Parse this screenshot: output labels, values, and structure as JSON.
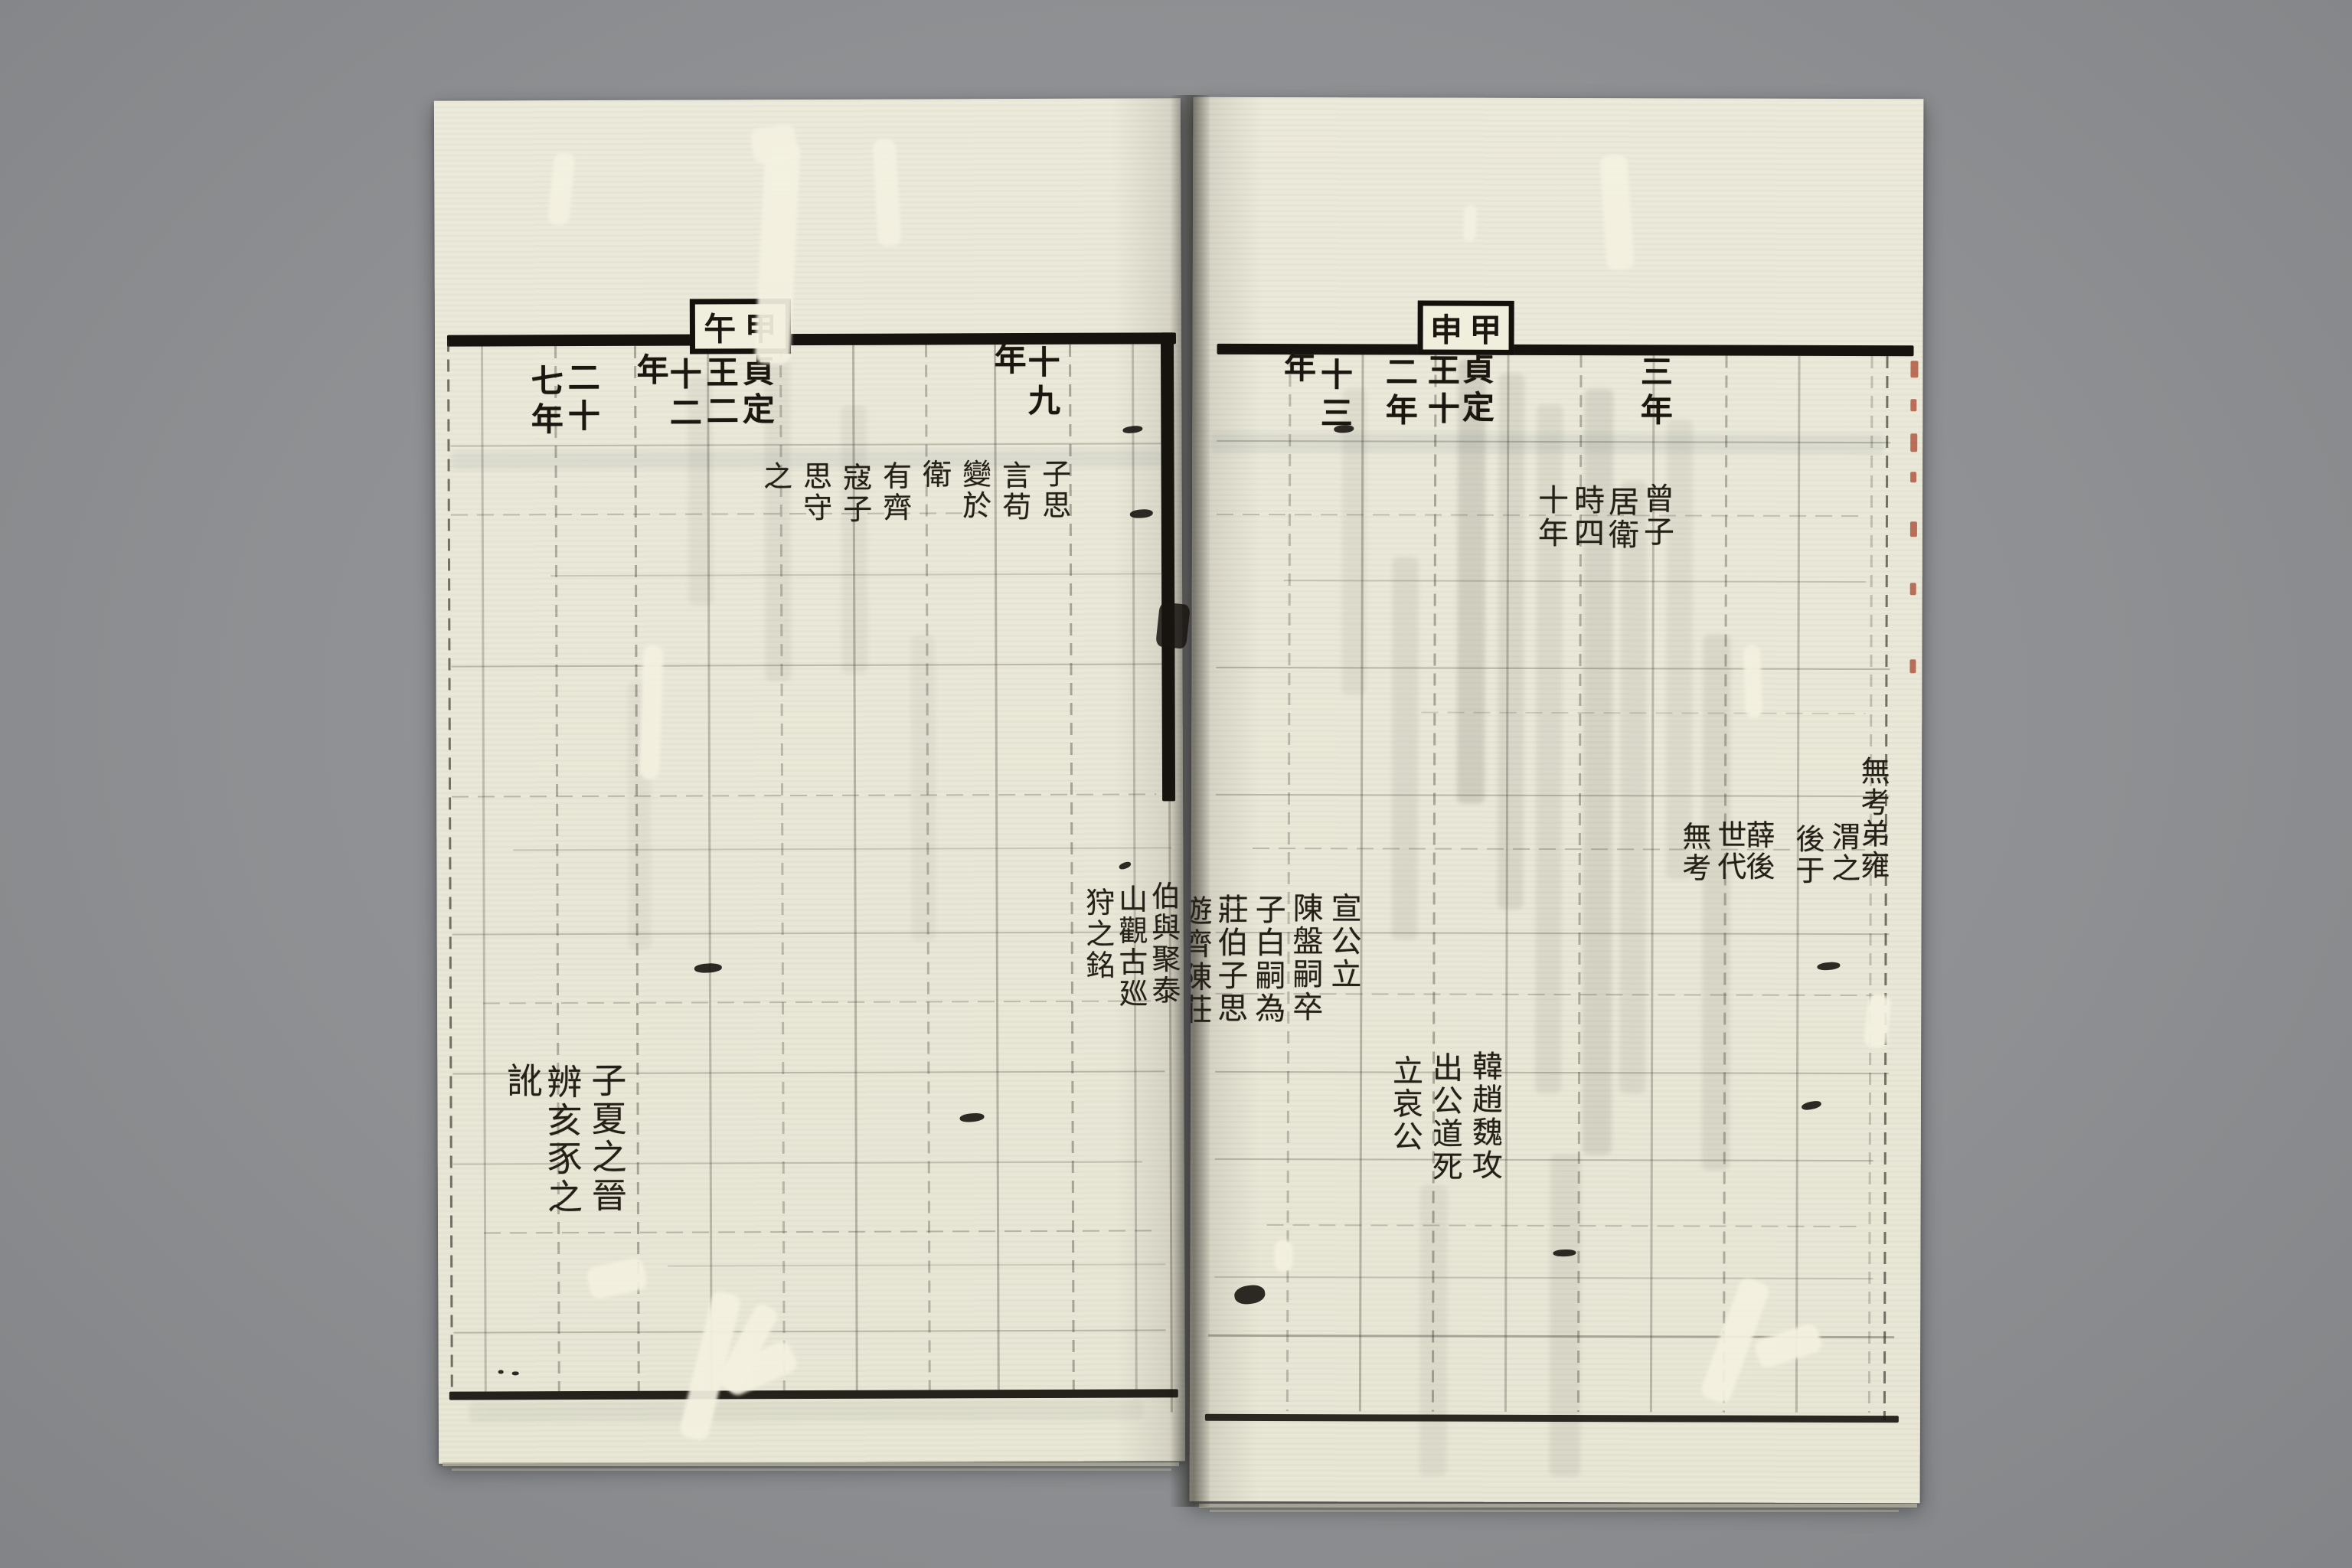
{
  "document": {
    "type": "woodblock-printed chronological table, open book spread",
    "left_page": {
      "cyclical_year_box": [
        "甲",
        "午"
      ],
      "year_headers": [
        {
          "id": "year-19",
          "columns": [
            "十九",
            "年"
          ]
        },
        {
          "id": "year-22",
          "columns": [
            "貞定",
            "王二",
            "十二",
            "年"
          ]
        },
        {
          "id": "year-27",
          "columns": [
            "二十",
            "七年"
          ]
        }
      ],
      "annotations": [
        {
          "id": "zisi-note",
          "columns": [
            "子思",
            "言苟",
            "變於",
            "衛",
            "有齊",
            "寇子",
            "思守",
            "之"
          ]
        },
        {
          "id": "taishan-note",
          "columns": [
            "伯與聚泰",
            "山觀古廵",
            "狩之銘"
          ]
        },
        {
          "id": "zixia-note",
          "columns": [
            "子夏之晉",
            "辨亥豕之",
            "訛"
          ]
        }
      ]
    },
    "right_page": {
      "cyclical_year_box": [
        "甲",
        "申"
      ],
      "year_headers": [
        {
          "id": "year-3",
          "columns": [
            "三年"
          ]
        },
        {
          "id": "year-12",
          "columns": [
            "貞定",
            "王十",
            "二年"
          ]
        },
        {
          "id": "year-13",
          "columns": [
            "十三",
            "年"
          ]
        }
      ],
      "annotations": [
        {
          "id": "zengzi-note",
          "columns": [
            "曾子",
            "居衛",
            "時四",
            "十年"
          ]
        },
        {
          "id": "wukao-note",
          "columns": [
            "無考弟雍",
            "渭之",
            "後于",
            "薛後",
            "世代",
            "無考"
          ]
        },
        {
          "id": "xuangong-note",
          "columns": [
            "宣公立",
            "陳盤嗣卒",
            "子白嗣為",
            "莊伯子思",
            "遊齊陳莊"
          ]
        },
        {
          "id": "sanjin-note",
          "columns": [
            "韓趙魏攻",
            "出公道死",
            "立哀公"
          ]
        }
      ]
    }
  },
  "colors": {
    "background": "#8e9093",
    "paper": "#e9e7d7",
    "ink": "#241f17",
    "rule": "#16120d",
    "red_edge_marks": "#a8462c"
  }
}
